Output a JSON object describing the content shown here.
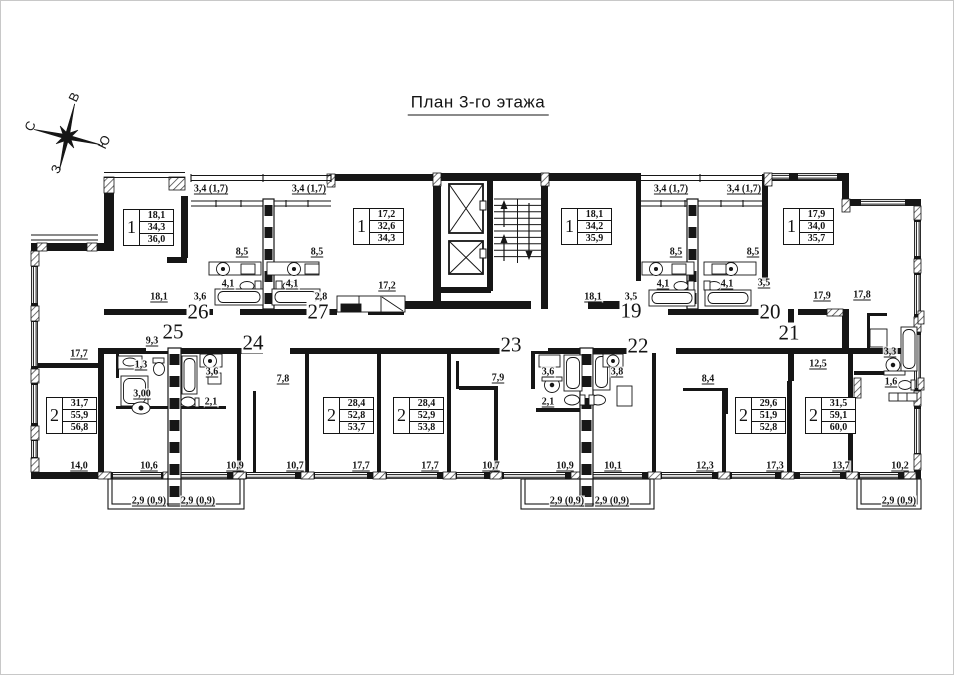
{
  "title": {
    "text": "План 3-го этажа"
  },
  "compass": {
    "points": [
      {
        "label": "В",
        "x": 73,
        "y": 96
      },
      {
        "label": "С",
        "x": 29,
        "y": 125
      },
      {
        "label": "Ю",
        "x": 103,
        "y": 141
      },
      {
        "label": "З",
        "x": 55,
        "y": 168
      }
    ]
  },
  "apartment_numbers": [
    {
      "num": "26",
      "x": 197,
      "y": 311
    },
    {
      "num": "27",
      "x": 317,
      "y": 311
    },
    {
      "num": "19",
      "x": 630,
      "y": 310
    },
    {
      "num": "20",
      "x": 769,
      "y": 311
    },
    {
      "num": "25",
      "x": 172,
      "y": 331
    },
    {
      "num": "24",
      "x": 252,
      "y": 342
    },
    {
      "num": "23",
      "x": 510,
      "y": 344
    },
    {
      "num": "22",
      "x": 637,
      "y": 345
    },
    {
      "num": "21",
      "x": 788,
      "y": 332
    }
  ],
  "unit_tables": [
    {
      "rooms": "1",
      "lines": [
        "18,1",
        "34,3",
        "36,0"
      ],
      "x": 122,
      "y": 208
    },
    {
      "rooms": "1",
      "lines": [
        "17,2",
        "32,6",
        "34,3"
      ],
      "x": 352,
      "y": 207
    },
    {
      "rooms": "1",
      "lines": [
        "18,1",
        "34,2",
        "35,9"
      ],
      "x": 560,
      "y": 207
    },
    {
      "rooms": "1",
      "lines": [
        "17,9",
        "34,0",
        "35,7"
      ],
      "x": 782,
      "y": 207
    },
    {
      "rooms": "2",
      "lines": [
        "31,7",
        "55,9",
        "56,8"
      ],
      "x": 45,
      "y": 396
    },
    {
      "rooms": "2",
      "lines": [
        "28,4",
        "52,8",
        "53,7"
      ],
      "x": 322,
      "y": 396
    },
    {
      "rooms": "2",
      "lines": [
        "28,4",
        "52,9",
        "53,8"
      ],
      "x": 392,
      "y": 396
    },
    {
      "rooms": "2",
      "lines": [
        "29,6",
        "51,9",
        "52,8"
      ],
      "x": 734,
      "y": 396
    },
    {
      "rooms": "2",
      "lines": [
        "31,5",
        "59,1",
        "60,0"
      ],
      "x": 804,
      "y": 396
    }
  ],
  "dimensions": [
    {
      "t": "3,4 (1,7)",
      "x": 210,
      "y": 188
    },
    {
      "t": "3,4 (1,7)",
      "x": 308,
      "y": 188
    },
    {
      "t": "3,4 (1,7)",
      "x": 670,
      "y": 188
    },
    {
      "t": "3,4 (1,7)",
      "x": 743,
      "y": 188
    },
    {
      "t": "8,5",
      "x": 241,
      "y": 251
    },
    {
      "t": "8,5",
      "x": 316,
      "y": 251
    },
    {
      "t": "8,5",
      "x": 675,
      "y": 251
    },
    {
      "t": "8,5",
      "x": 752,
      "y": 251
    },
    {
      "t": "4,1",
      "x": 227,
      "y": 283
    },
    {
      "t": "4,1",
      "x": 291,
      "y": 283
    },
    {
      "t": "4,1",
      "x": 662,
      "y": 283
    },
    {
      "t": "4,1",
      "x": 726,
      "y": 283
    },
    {
      "t": "3,5",
      "x": 763,
      "y": 282
    },
    {
      "t": "17,2",
      "x": 386,
      "y": 285
    },
    {
      "t": "18,1",
      "x": 158,
      "y": 296
    },
    {
      "t": "3,6",
      "x": 199,
      "y": 296
    },
    {
      "t": "2,8",
      "x": 320,
      "y": 296
    },
    {
      "t": "18,1",
      "x": 592,
      "y": 296
    },
    {
      "t": "3,5",
      "x": 630,
      "y": 296
    },
    {
      "t": "17,9",
      "x": 821,
      "y": 295
    },
    {
      "t": "17,8",
      "x": 861,
      "y": 294
    },
    {
      "t": "17,7",
      "x": 78,
      "y": 353
    },
    {
      "t": "9,3",
      "x": 151,
      "y": 340
    },
    {
      "t": "1,3",
      "x": 140,
      "y": 364
    },
    {
      "t": "3,6",
      "x": 211,
      "y": 371
    },
    {
      "t": "3,00",
      "x": 141,
      "y": 393
    },
    {
      "t": "2,1",
      "x": 210,
      "y": 401
    },
    {
      "t": "7,8",
      "x": 282,
      "y": 378
    },
    {
      "t": "7,9",
      "x": 497,
      "y": 377
    },
    {
      "t": "3,6",
      "x": 547,
      "y": 371
    },
    {
      "t": "3,8",
      "x": 616,
      "y": 371
    },
    {
      "t": "2,1",
      "x": 547,
      "y": 401
    },
    {
      "t": "8,4",
      "x": 707,
      "y": 378
    },
    {
      "t": "12,5",
      "x": 817,
      "y": 363
    },
    {
      "t": "3,3",
      "x": 889,
      "y": 351
    },
    {
      "t": "1,6",
      "x": 890,
      "y": 381
    },
    {
      "t": "14,0",
      "x": 78,
      "y": 465
    },
    {
      "t": "10,6",
      "x": 148,
      "y": 465
    },
    {
      "t": "10,9",
      "x": 234,
      "y": 465
    },
    {
      "t": "10,7",
      "x": 294,
      "y": 465
    },
    {
      "t": "17,7",
      "x": 360,
      "y": 465
    },
    {
      "t": "17,7",
      "x": 429,
      "y": 465
    },
    {
      "t": "10,7",
      "x": 490,
      "y": 465
    },
    {
      "t": "10,9",
      "x": 564,
      "y": 465
    },
    {
      "t": "10,1",
      "x": 612,
      "y": 465
    },
    {
      "t": "12,3",
      "x": 704,
      "y": 465
    },
    {
      "t": "17,3",
      "x": 774,
      "y": 465
    },
    {
      "t": "13,7",
      "x": 840,
      "y": 465
    },
    {
      "t": "10,2",
      "x": 899,
      "y": 465
    },
    {
      "t": "2,9 (0,9)",
      "x": 148,
      "y": 500
    },
    {
      "t": "2,9 (0,9)",
      "x": 197,
      "y": 500
    },
    {
      "t": "2,9 (0,9)",
      "x": 566,
      "y": 500
    },
    {
      "t": "2,9 (0,9)",
      "x": 611,
      "y": 500
    },
    {
      "t": "2,9 (0,9)",
      "x": 898,
      "y": 500
    }
  ]
}
